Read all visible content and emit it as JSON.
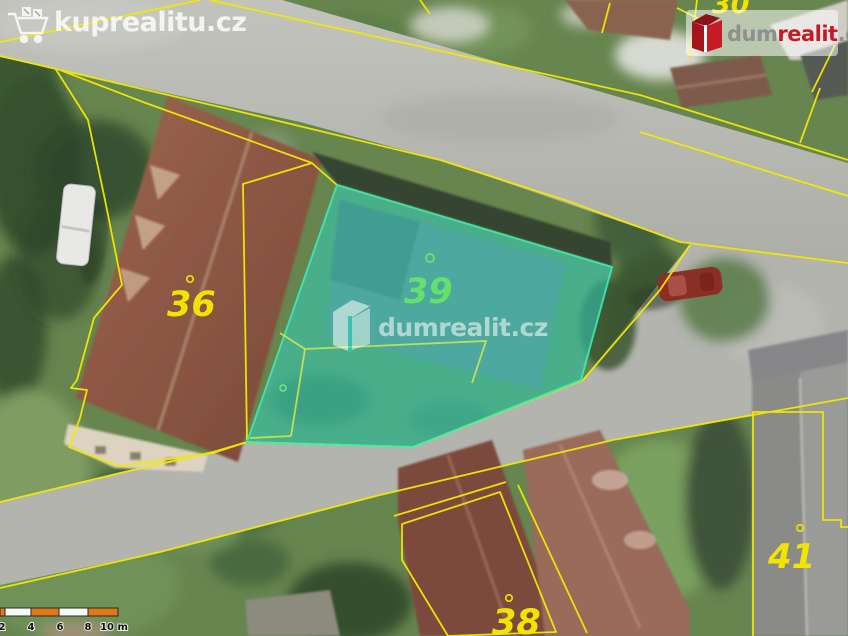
{
  "watermarks": {
    "top_left": {
      "text": "kuprealitu.cz",
      "icon": "shopping-cart-icon"
    },
    "center": {
      "text": "dumrealit.cz",
      "icon": "dumrealit-building-icon"
    },
    "top_right": {
      "dum": "dum",
      "realit": "realit",
      "cz": ".cz",
      "icon": "dumrealit-building-icon"
    }
  },
  "map": {
    "type": "aerial-cadastral",
    "colors": {
      "cadastral_line": "#f2ea00",
      "highlight_fill": "#2bd8c6",
      "highlight_border": "#3fe9ae",
      "label_yellow": "#f0e400",
      "label_green": "#63e26b",
      "logo_red": "#c61a27"
    },
    "parcels": [
      {
        "number": "30",
        "label_color": "yellow"
      },
      {
        "number": "36",
        "label_color": "yellow"
      },
      {
        "number": "39",
        "label_color": "green",
        "highlighted": true
      },
      {
        "number": "38",
        "label_color": "yellow"
      },
      {
        "number": "41",
        "label_color": "yellow"
      }
    ]
  },
  "scalebar": {
    "ticks": [
      "2",
      "4",
      "6",
      "8",
      "10 m"
    ],
    "unit": "m"
  }
}
